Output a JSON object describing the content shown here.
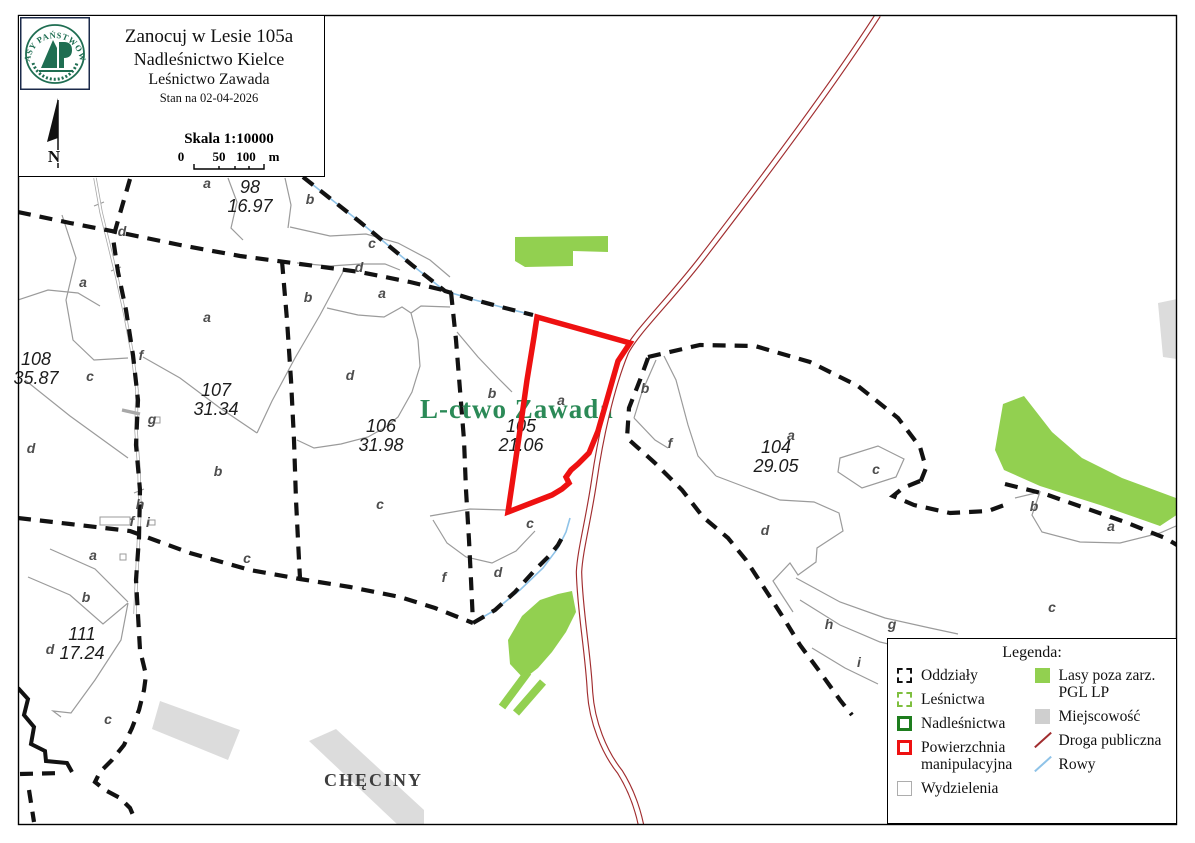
{
  "header": {
    "logo_text": "LASY PAŃSTWOWE",
    "title_line1": "Zanocuj w Lesie 105a",
    "title_line2": "Nadleśnictwo Kielce",
    "title_line3": "Leśnictwo Zawada",
    "title_line4": "Stan na 02-04-2026",
    "north": "N",
    "scale": {
      "label": "Skala 1:10000",
      "t0": "0",
      "t50": "50",
      "t100": "100",
      "unit": "m"
    }
  },
  "map": {
    "forest_district_label": "L-ctwo Zawada",
    "town_label": "CHĘCINY",
    "compartments": [
      {
        "number": "98",
        "area": "16.97",
        "x": 250,
        "y": 197
      },
      {
        "number": "108",
        "area": "35.87",
        "x": 36,
        "y": 369
      },
      {
        "number": "107",
        "area": "31.34",
        "x": 216,
        "y": 400
      },
      {
        "number": "106",
        "area": "31.98",
        "x": 381,
        "y": 436
      },
      {
        "number": "105",
        "area": "21.06",
        "x": 521,
        "y": 436
      },
      {
        "number": "104",
        "area": "29.05",
        "x": 776,
        "y": 457
      },
      {
        "number": "111",
        "area": "17.24",
        "x": 82,
        "y": 644
      }
    ],
    "letters": [
      {
        "t": "a",
        "x": 207,
        "y": 183
      },
      {
        "t": "b",
        "x": 310,
        "y": 199
      },
      {
        "t": "c",
        "x": 372,
        "y": 243
      },
      {
        "t": "d",
        "x": 359,
        "y": 267
      },
      {
        "t": "d",
        "x": 122,
        "y": 231
      },
      {
        "t": "a",
        "x": 83,
        "y": 282
      },
      {
        "t": "b",
        "x": 308,
        "y": 297
      },
      {
        "t": "a",
        "x": 382,
        "y": 293
      },
      {
        "t": "a",
        "x": 207,
        "y": 317
      },
      {
        "t": "f",
        "x": 141,
        "y": 355
      },
      {
        "t": "c",
        "x": 90,
        "y": 376
      },
      {
        "t": "g",
        "x": 152,
        "y": 419
      },
      {
        "t": "d",
        "x": 31,
        "y": 448
      },
      {
        "t": "b",
        "x": 218,
        "y": 471
      },
      {
        "t": "d",
        "x": 350,
        "y": 375
      },
      {
        "t": "b",
        "x": 492,
        "y": 393
      },
      {
        "t": "a",
        "x": 561,
        "y": 400
      },
      {
        "t": "b",
        "x": 645,
        "y": 388
      },
      {
        "t": "f",
        "x": 670,
        "y": 443
      },
      {
        "t": "a",
        "x": 791,
        "y": 435
      },
      {
        "t": "c",
        "x": 876,
        "y": 469
      },
      {
        "t": "d",
        "x": 765,
        "y": 530
      },
      {
        "t": "c",
        "x": 380,
        "y": 504
      },
      {
        "t": "c",
        "x": 247,
        "y": 558
      },
      {
        "t": "h",
        "x": 140,
        "y": 504
      },
      {
        "t": "f",
        "x": 132,
        "y": 521
      },
      {
        "t": "i",
        "x": 148,
        "y": 522
      },
      {
        "t": "a",
        "x": 93,
        "y": 555
      },
      {
        "t": "b",
        "x": 86,
        "y": 597
      },
      {
        "t": "d",
        "x": 50,
        "y": 649
      },
      {
        "t": "c",
        "x": 108,
        "y": 719
      },
      {
        "t": "c",
        "x": 530,
        "y": 523
      },
      {
        "t": "f",
        "x": 444,
        "y": 577
      },
      {
        "t": "d",
        "x": 498,
        "y": 572
      },
      {
        "t": "h",
        "x": 829,
        "y": 624
      },
      {
        "t": "g",
        "x": 892,
        "y": 624
      },
      {
        "t": "i",
        "x": 859,
        "y": 662
      },
      {
        "t": "b",
        "x": 1034,
        "y": 506
      },
      {
        "t": "a",
        "x": 1111,
        "y": 526
      },
      {
        "t": "c",
        "x": 1052,
        "y": 607
      }
    ]
  },
  "legend": {
    "title": "Legenda:",
    "items_left": [
      {
        "label": "Oddziały",
        "swatch": "oddzialy"
      },
      {
        "label": "Leśnictwa",
        "swatch": "lesnictwa"
      },
      {
        "label": "Nadleśnictwa",
        "swatch": "nadlesnictwa"
      },
      {
        "label": "Powierzchnia manipulacyjna",
        "swatch": "powierzchnia"
      },
      {
        "label": "Wydzielenia",
        "swatch": "wydzielenia"
      }
    ],
    "items_right": [
      {
        "label": "Lasy poza zarz. PGL LP",
        "swatch": "lasy"
      },
      {
        "label": "Miejscowość",
        "swatch": "miejscowosc"
      },
      {
        "label": "Droga publiczna",
        "swatch": "droga"
      },
      {
        "label": "Rowy",
        "swatch": "rowy"
      }
    ]
  },
  "colors": {
    "red": "#ee1111",
    "road": "#a12d2f",
    "green": "#92d050",
    "gray_area": "#dcdcdc",
    "rowy": "#8fc3e8",
    "forest_text": "#2b8a57",
    "logo_green": "#1f6e52",
    "lesnictwa_green": "#7fbf3f",
    "nadlesnictwa_green": "#1e7d1e"
  }
}
